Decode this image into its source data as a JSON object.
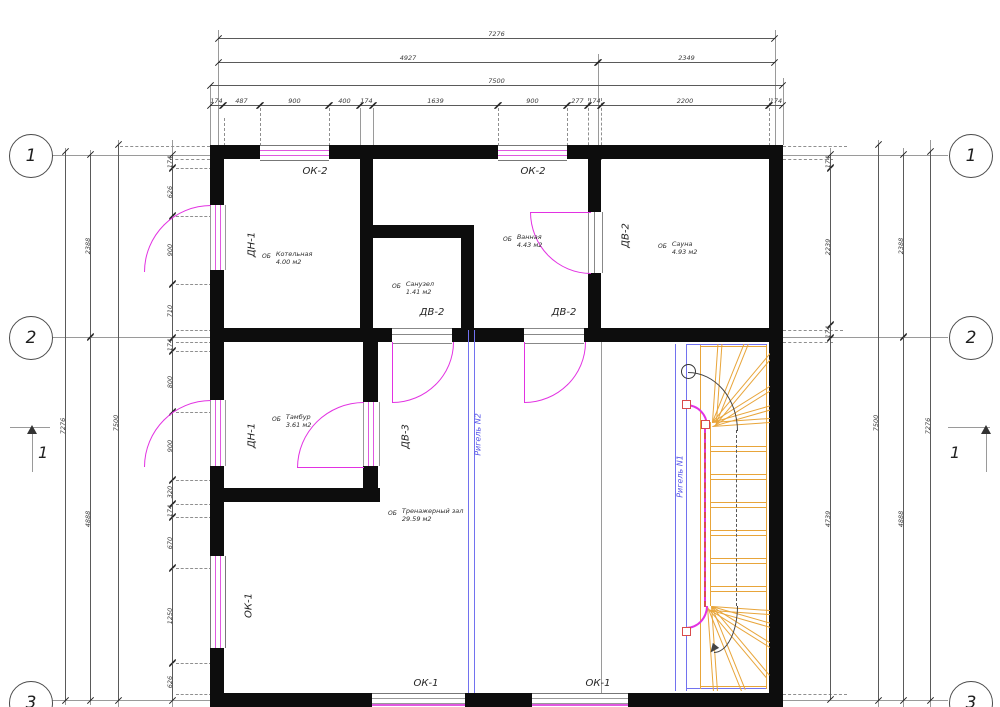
{
  "drawing": {
    "kind": "architectural floor plan",
    "axes": {
      "left": [
        "1",
        "2",
        "3"
      ],
      "right": [
        "1",
        "2",
        "3"
      ]
    },
    "sections": {
      "left": "1",
      "right": "1"
    },
    "dims": {
      "top": {
        "overall": "7276",
        "tier2": [
          "4927",
          "2349"
        ],
        "total": "7500",
        "segments": [
          "174",
          "487",
          "900",
          "400",
          "174",
          "1639",
          "900",
          "277",
          "174",
          "2200",
          "174"
        ]
      },
      "left": {
        "overall": "7276",
        "total": "7500",
        "spans": [
          "2388",
          "4888"
        ],
        "segments": [
          "174",
          "626",
          "900",
          "710",
          "174",
          "800",
          "900",
          "320",
          "174",
          "670",
          "1250",
          "626"
        ]
      },
      "right": {
        "overall": "7276",
        "total": "7500",
        "spans": [
          "2388",
          "4888"
        ],
        "segments": [
          "174",
          "2239",
          "174",
          "4739"
        ]
      }
    },
    "rooms": [
      {
        "prefix": "ОБ",
        "name": "Котельная",
        "area": "4.00 м2"
      },
      {
        "prefix": "ОБ",
        "name": "Ванная",
        "area": "4.43 м2"
      },
      {
        "prefix": "ОБ",
        "name": "Санузел",
        "area": "1.41 м2"
      },
      {
        "prefix": "ОБ",
        "name": "Сауна",
        "area": "4.93 м2"
      },
      {
        "prefix": "ОБ",
        "name": "Тамбур",
        "area": "3.61 м2"
      },
      {
        "prefix": "ОБ",
        "name": "Тренажерный зал",
        "area": "29.59 м2"
      }
    ],
    "openings": {
      "ok2_a": "ОК-2",
      "ok2_b": "ОК-2",
      "ok1_left": "ОК-1",
      "ok1_bottom_a": "ОК-1",
      "ok1_bottom_b": "ОК-1",
      "dn1_a": "ДН-1",
      "dn1_b": "ДН-1",
      "dv2_a": "ДВ-2",
      "dv2_b": "ДВ-2",
      "dv2_c": "ДВ-2",
      "dv3": "ДВ-3"
    },
    "beams": {
      "n2": "Ригель N2",
      "n1": "Ригель N1"
    },
    "colors": {
      "wall": "#0d0d0d",
      "door_magenta": "#e232e2",
      "window_pink": "#e058e0",
      "beam_blue": "#7272ef",
      "stair_orange": "#e8a53a",
      "rail_red": "#d94b4b",
      "line_gray": "#9a9a9a",
      "dim_text": "#3c3c3c"
    }
  }
}
